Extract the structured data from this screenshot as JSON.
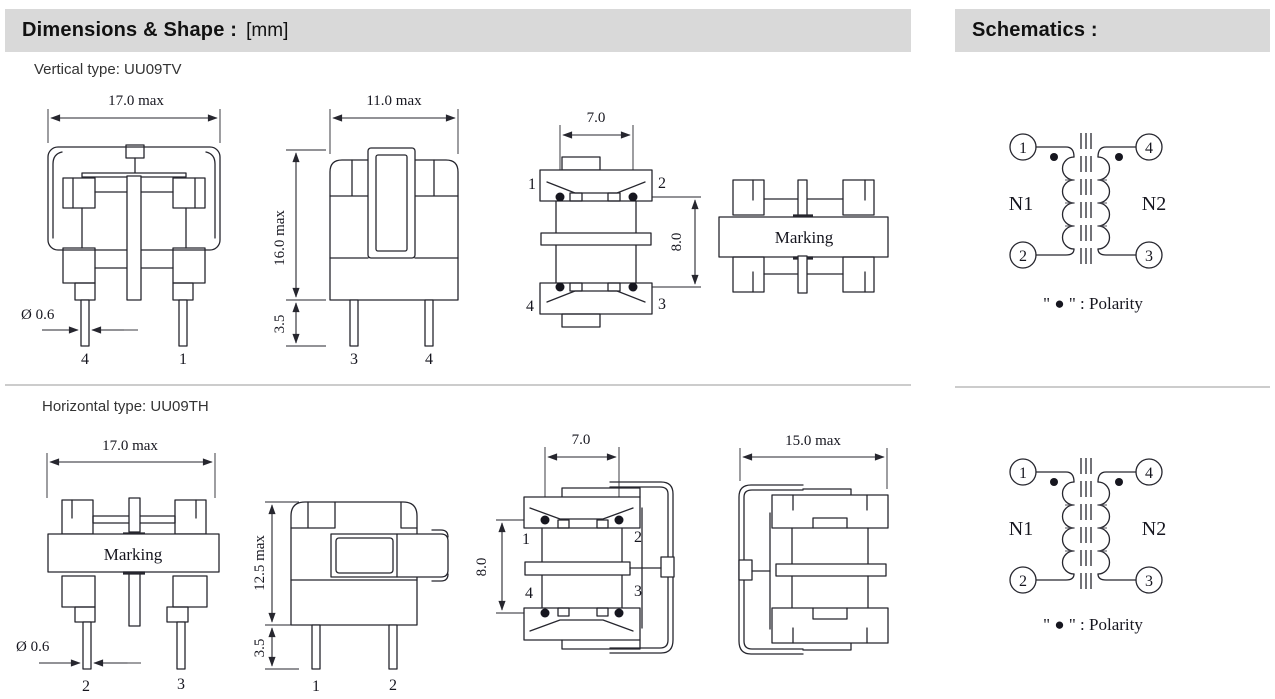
{
  "header": {
    "dimensions_title": "Dimensions & Shape :",
    "dimensions_unit": "[mm]",
    "schematics_title": "Schematics :"
  },
  "vertical": {
    "type_label": "Vertical type: UU09TV",
    "front": {
      "width": "17.0 max",
      "pin_diameter": "Ø 0.6",
      "pin_left": "4",
      "pin_right": "1"
    },
    "side": {
      "depth": "11.0 max",
      "height": "16.0 max",
      "pin_length": "3.5",
      "pin_left": "3",
      "pin_right": "4"
    },
    "bottom": {
      "pin_pitch": "7.0",
      "row_pitch": "8.0",
      "pin_tl": "1",
      "pin_tr": "2",
      "pin_bl": "4",
      "pin_br": "3"
    },
    "top": {
      "marking": "Marking"
    }
  },
  "horizontal": {
    "type_label": "Horizontal type: UU09TH",
    "front": {
      "width": "17.0 max",
      "marking": "Marking",
      "pin_diameter": "Ø 0.6",
      "pin_left": "2",
      "pin_right": "3"
    },
    "side": {
      "height": "12.5 max",
      "pin_length": "3.5",
      "pin_left": "1",
      "pin_right": "2"
    },
    "bottom": {
      "pin_pitch": "7.0",
      "row_pitch": "8.0",
      "pin_tl": "1",
      "pin_tr": "2",
      "pin_bl": "4",
      "pin_br": "3"
    },
    "top": {
      "width": "15.0 max"
    }
  },
  "schematic": {
    "pin_top_left": "1",
    "pin_top_right": "4",
    "pin_bottom_left": "2",
    "pin_bottom_right": "3",
    "winding_left": "N1",
    "winding_right": "N2",
    "polarity_note": "\" ● \" :  Polarity"
  },
  "colors": {
    "header_bg": "#d9d9d9",
    "line": "#26262e",
    "divider": "#cccccc"
  }
}
